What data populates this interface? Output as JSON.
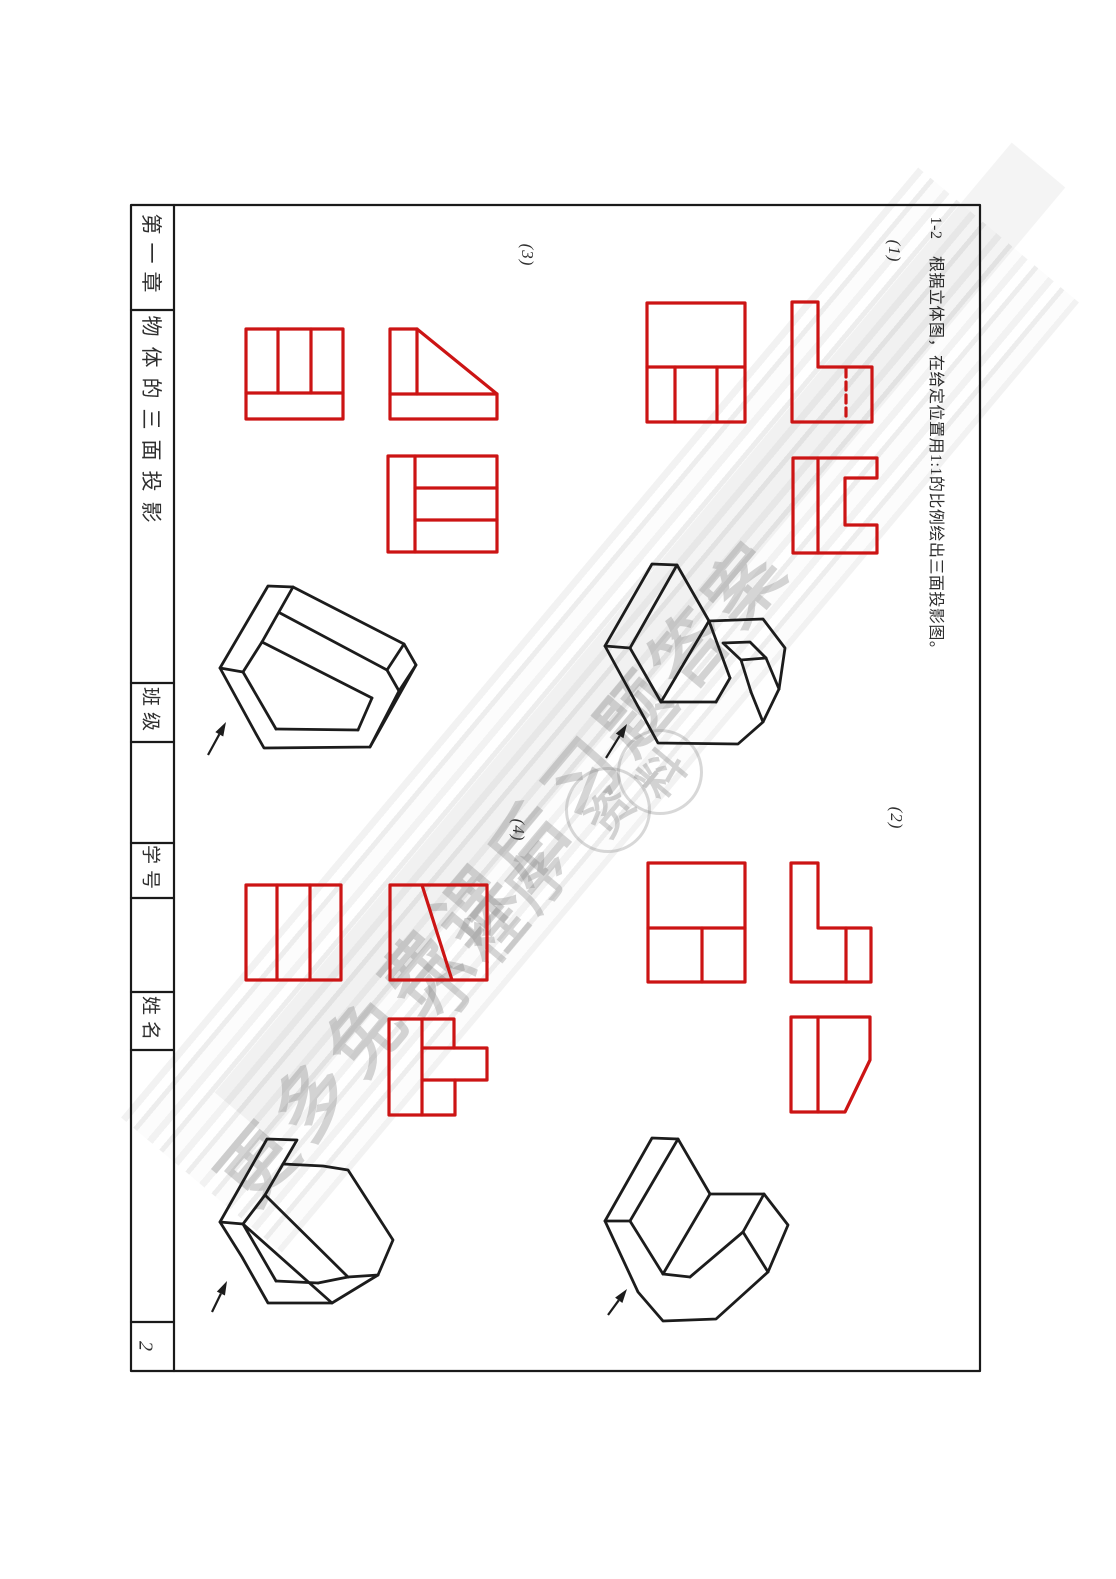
{
  "page": {
    "number": "2"
  },
  "sidebar": {
    "chapter": "第一章",
    "section_title": "物体的三面投影",
    "class_label": "班级",
    "student_id_label": "学号",
    "name_label": "姓名"
  },
  "exercise": {
    "instruction": "1-2　根据立体图，在给定位置用1:1的比例绘出三面投影图。",
    "part1": "(1)",
    "part2": "(2)",
    "part3": "(3)",
    "part4": "(4)"
  },
  "watermark": {
    "line1": "更多免费课后习题答案",
    "line2": "小程序",
    "stamp1": "资",
    "stamp2": "料"
  },
  "colors": {
    "projection_line": "#cc1414",
    "solid_line": "#1c1c1c",
    "frame_line": "#1a1a1a"
  },
  "drawings": {
    "frame": [
      {
        "t": "r",
        "x": 131,
        "y": 205,
        "w": 849,
        "h": 1166
      },
      {
        "t": "l",
        "pts": [
          [
            174,
            205
          ],
          [
            174,
            1371
          ]
        ]
      },
      {
        "t": "l",
        "pts": [
          [
            131,
            310
          ],
          [
            174,
            310
          ]
        ]
      },
      {
        "t": "l",
        "pts": [
          [
            131,
            683
          ],
          [
            174,
            683
          ]
        ]
      },
      {
        "t": "l",
        "pts": [
          [
            131,
            742
          ],
          [
            174,
            742
          ]
        ]
      },
      {
        "t": "l",
        "pts": [
          [
            131,
            843
          ],
          [
            174,
            843
          ]
        ]
      },
      {
        "t": "l",
        "pts": [
          [
            131,
            898
          ],
          [
            174,
            898
          ]
        ]
      },
      {
        "t": "l",
        "pts": [
          [
            131,
            992
          ],
          [
            174,
            992
          ]
        ]
      },
      {
        "t": "l",
        "pts": [
          [
            131,
            1050
          ],
          [
            174,
            1050
          ]
        ]
      },
      {
        "t": "l",
        "pts": [
          [
            131,
            1322
          ],
          [
            174,
            1322
          ]
        ]
      }
    ],
    "views": [
      {
        "t": "r",
        "x": 647,
        "y": 303,
        "w": 98,
        "h": 119
      },
      {
        "t": "l",
        "pts": [
          [
            647,
            367
          ],
          [
            745,
            367
          ]
        ]
      },
      {
        "t": "l",
        "pts": [
          [
            675,
            367
          ],
          [
            675,
            422
          ]
        ]
      },
      {
        "t": "l",
        "pts": [
          [
            717,
            367
          ],
          [
            717,
            422
          ]
        ]
      },
      {
        "t": "p",
        "pts": [
          [
            792,
            302
          ],
          [
            818,
            302
          ],
          [
            818,
            367
          ],
          [
            872,
            367
          ],
          [
            872,
            422
          ],
          [
            792,
            422
          ]
        ]
      },
      {
        "t": "l",
        "d": 1,
        "pts": [
          [
            846,
            369
          ],
          [
            846,
            421
          ]
        ]
      },
      {
        "t": "p",
        "pts": [
          [
            793,
            458
          ],
          [
            877,
            458
          ],
          [
            877,
            478
          ],
          [
            845,
            478
          ],
          [
            845,
            525
          ],
          [
            877,
            525
          ],
          [
            877,
            553
          ],
          [
            793,
            553
          ]
        ]
      },
      {
        "t": "l",
        "pts": [
          [
            818,
            458
          ],
          [
            818,
            553
          ]
        ]
      },
      {
        "t": "r",
        "x": 246,
        "y": 329,
        "w": 97,
        "h": 90
      },
      {
        "t": "l",
        "pts": [
          [
            246,
            393
          ],
          [
            343,
            393
          ]
        ]
      },
      {
        "t": "l",
        "pts": [
          [
            278,
            329
          ],
          [
            278,
            393
          ]
        ]
      },
      {
        "t": "l",
        "pts": [
          [
            311,
            329
          ],
          [
            311,
            393
          ]
        ]
      },
      {
        "t": "p",
        "pts": [
          [
            390,
            329
          ],
          [
            417,
            329
          ],
          [
            497,
            394
          ],
          [
            497,
            419
          ],
          [
            390,
            419
          ]
        ]
      },
      {
        "t": "l",
        "pts": [
          [
            390,
            394
          ],
          [
            497,
            394
          ]
        ]
      },
      {
        "t": "l",
        "pts": [
          [
            417,
            329
          ],
          [
            417,
            394
          ]
        ]
      },
      {
        "t": "r",
        "x": 388,
        "y": 456,
        "w": 109,
        "h": 96
      },
      {
        "t": "l",
        "pts": [
          [
            415,
            456
          ],
          [
            415,
            552
          ]
        ]
      },
      {
        "t": "l",
        "pts": [
          [
            415,
            488
          ],
          [
            497,
            488
          ]
        ]
      },
      {
        "t": "l",
        "pts": [
          [
            415,
            520
          ],
          [
            497,
            520
          ]
        ]
      },
      {
        "t": "r",
        "x": 648,
        "y": 863,
        "w": 97,
        "h": 119
      },
      {
        "t": "l",
        "pts": [
          [
            648,
            928
          ],
          [
            745,
            928
          ]
        ]
      },
      {
        "t": "l",
        "pts": [
          [
            702,
            928
          ],
          [
            702,
            982
          ]
        ]
      },
      {
        "t": "p",
        "pts": [
          [
            791,
            863
          ],
          [
            818,
            863
          ],
          [
            818,
            928
          ],
          [
            871,
            928
          ],
          [
            871,
            982
          ],
          [
            791,
            982
          ]
        ]
      },
      {
        "t": "l",
        "pts": [
          [
            846,
            928
          ],
          [
            846,
            982
          ]
        ]
      },
      {
        "t": "p",
        "pts": [
          [
            791,
            1017
          ],
          [
            870,
            1017
          ],
          [
            870,
            1060
          ],
          [
            845,
            1112
          ],
          [
            791,
            1112
          ]
        ]
      },
      {
        "t": "l",
        "pts": [
          [
            818,
            1017
          ],
          [
            818,
            1112
          ]
        ]
      },
      {
        "t": "r",
        "x": 246,
        "y": 885,
        "w": 95,
        "h": 95
      },
      {
        "t": "l",
        "pts": [
          [
            277,
            885
          ],
          [
            277,
            980
          ]
        ]
      },
      {
        "t": "l",
        "pts": [
          [
            310,
            885
          ],
          [
            310,
            980
          ]
        ]
      },
      {
        "t": "r",
        "x": 390,
        "y": 885,
        "w": 97,
        "h": 95
      },
      {
        "t": "l",
        "pts": [
          [
            422,
            885
          ],
          [
            452,
            980
          ]
        ]
      },
      {
        "t": "p",
        "pts": [
          [
            389,
            1019
          ],
          [
            454,
            1019
          ],
          [
            454,
            1048
          ],
          [
            487,
            1048
          ],
          [
            487,
            1080
          ],
          [
            455,
            1080
          ],
          [
            455,
            1115
          ],
          [
            389,
            1115
          ]
        ]
      },
      {
        "t": "l",
        "pts": [
          [
            422,
            1019
          ],
          [
            422,
            1115
          ]
        ]
      },
      {
        "t": "l",
        "pts": [
          [
            422,
            1048
          ],
          [
            454,
            1048
          ]
        ]
      },
      {
        "t": "l",
        "pts": [
          [
            422,
            1080
          ],
          [
            455,
            1080
          ]
        ]
      }
    ],
    "solids": [
      {
        "t": "p",
        "pts": [
          [
            652,
            564
          ],
          [
            677,
            565
          ],
          [
            709,
            621
          ],
          [
            763,
            619
          ],
          [
            785,
            648
          ],
          [
            779,
            689
          ],
          [
            763,
            722
          ],
          [
            738,
            744
          ],
          [
            658,
            743
          ],
          [
            605,
            646
          ]
        ]
      },
      {
        "t": "l",
        "pts": [
          [
            677,
            565
          ],
          [
            630,
            648
          ]
        ]
      },
      {
        "t": "l",
        "pts": [
          [
            605,
            646
          ],
          [
            630,
            648
          ]
        ]
      },
      {
        "t": "l",
        "pts": [
          [
            630,
            648
          ],
          [
            661,
            702
          ]
        ]
      },
      {
        "t": "l",
        "pts": [
          [
            709,
            621
          ],
          [
            661,
            702
          ]
        ]
      },
      {
        "t": "l",
        "pts": [
          [
            661,
            702
          ],
          [
            716,
            702
          ]
        ]
      },
      {
        "t": "l",
        "pts": [
          [
            716,
            702
          ],
          [
            730,
            678
          ]
        ]
      },
      {
        "t": "l",
        "pts": [
          [
            730,
            678
          ],
          [
            709,
            621
          ]
        ]
      },
      {
        "t": "p",
        "pts": [
          [
            723,
            643
          ],
          [
            750,
            642
          ],
          [
            766,
            658
          ],
          [
            741,
            660
          ]
        ]
      },
      {
        "t": "l",
        "pts": [
          [
            766,
            658
          ],
          [
            779,
            689
          ]
        ]
      },
      {
        "t": "l",
        "pts": [
          [
            741,
            660
          ],
          [
            751,
            692
          ]
        ]
      },
      {
        "t": "l",
        "pts": [
          [
            751,
            692
          ],
          [
            763,
            722
          ]
        ]
      },
      {
        "t": "p",
        "pts": [
          [
            652,
            1138
          ],
          [
            678,
            1139
          ],
          [
            710,
            1194
          ],
          [
            764,
            1194
          ],
          [
            788,
            1225
          ],
          [
            768,
            1272
          ],
          [
            716,
            1319
          ],
          [
            663,
            1321
          ],
          [
            638,
            1292
          ],
          [
            605,
            1221
          ]
        ]
      },
      {
        "t": "l",
        "pts": [
          [
            678,
            1139
          ],
          [
            630,
            1221
          ]
        ]
      },
      {
        "t": "l",
        "pts": [
          [
            605,
            1221
          ],
          [
            630,
            1221
          ]
        ]
      },
      {
        "t": "l",
        "pts": [
          [
            630,
            1221
          ],
          [
            663,
            1274
          ]
        ]
      },
      {
        "t": "l",
        "pts": [
          [
            710,
            1194
          ],
          [
            663,
            1274
          ]
        ]
      },
      {
        "t": "l",
        "pts": [
          [
            663,
            1274
          ],
          [
            690,
            1277
          ]
        ]
      },
      {
        "t": "l",
        "pts": [
          [
            690,
            1277
          ],
          [
            743,
            1232
          ]
        ]
      },
      {
        "t": "l",
        "pts": [
          [
            743,
            1232
          ],
          [
            764,
            1194
          ]
        ]
      },
      {
        "t": "l",
        "pts": [
          [
            743,
            1232
          ],
          [
            768,
            1272
          ]
        ]
      },
      {
        "t": "p",
        "pts": [
          [
            268,
            586
          ],
          [
            293,
            587
          ],
          [
            404,
            644
          ],
          [
            416,
            665
          ],
          [
            370,
            747
          ],
          [
            264,
            748
          ],
          [
            255,
            732
          ],
          [
            220,
            668
          ]
        ]
      },
      {
        "t": "l",
        "pts": [
          [
            293,
            587
          ],
          [
            262,
            642
          ]
        ]
      },
      {
        "t": "l",
        "pts": [
          [
            220,
            668
          ],
          [
            243,
            672
          ]
        ]
      },
      {
        "t": "l",
        "pts": [
          [
            243,
            672
          ],
          [
            262,
            642
          ]
        ]
      },
      {
        "t": "l",
        "pts": [
          [
            280,
            613
          ],
          [
            387,
            670
          ]
        ]
      },
      {
        "t": "l",
        "pts": [
          [
            262,
            642
          ],
          [
            372,
            698
          ]
        ]
      },
      {
        "t": "l",
        "pts": [
          [
            404,
            644
          ],
          [
            387,
            670
          ]
        ]
      },
      {
        "t": "l",
        "pts": [
          [
            387,
            670
          ],
          [
            399,
            691
          ]
        ]
      },
      {
        "t": "l",
        "pts": [
          [
            416,
            665
          ],
          [
            399,
            691
          ]
        ]
      },
      {
        "t": "l",
        "pts": [
          [
            399,
            691
          ],
          [
            370,
            747
          ]
        ]
      },
      {
        "t": "l",
        "pts": [
          [
            243,
            672
          ],
          [
            276,
            729
          ]
        ]
      },
      {
        "t": "l",
        "pts": [
          [
            276,
            729
          ],
          [
            358,
            730
          ]
        ]
      },
      {
        "t": "l",
        "pts": [
          [
            358,
            730
          ],
          [
            372,
            698
          ]
        ]
      },
      {
        "t": "p",
        "pts": [
          [
            267,
            1139
          ],
          [
            297,
            1140
          ],
          [
            283,
            1164
          ],
          [
            323,
            1166
          ],
          [
            348,
            1170
          ],
          [
            393,
            1240
          ],
          [
            378,
            1275
          ],
          [
            332,
            1303
          ],
          [
            268,
            1303
          ],
          [
            242,
            1257
          ],
          [
            220,
            1222
          ]
        ]
      },
      {
        "t": "l",
        "pts": [
          [
            283,
            1164
          ],
          [
            265,
            1195
          ]
        ]
      },
      {
        "t": "l",
        "pts": [
          [
            220,
            1222
          ],
          [
            243,
            1224
          ]
        ]
      },
      {
        "t": "l",
        "pts": [
          [
            243,
            1224
          ],
          [
            265,
            1195
          ]
        ]
      },
      {
        "t": "l",
        "pts": [
          [
            265,
            1195
          ],
          [
            348,
            1277
          ]
        ]
      },
      {
        "t": "l",
        "pts": [
          [
            243,
            1224
          ],
          [
            332,
            1303
          ]
        ]
      },
      {
        "t": "l",
        "pts": [
          [
            348,
            1277
          ],
          [
            378,
            1275
          ]
        ]
      },
      {
        "t": "l",
        "pts": [
          [
            243,
            1224
          ],
          [
            276,
            1281
          ]
        ]
      },
      {
        "t": "l",
        "pts": [
          [
            276,
            1281
          ],
          [
            318,
            1283
          ]
        ]
      },
      {
        "t": "l",
        "pts": [
          [
            318,
            1283
          ],
          [
            348,
            1277
          ]
        ]
      }
    ],
    "arrows": [
      [
        606,
        758,
        627,
        724
      ],
      [
        608,
        1315,
        627,
        1289
      ],
      [
        208,
        755,
        226,
        722
      ],
      [
        212,
        1312,
        227,
        1281
      ]
    ]
  }
}
